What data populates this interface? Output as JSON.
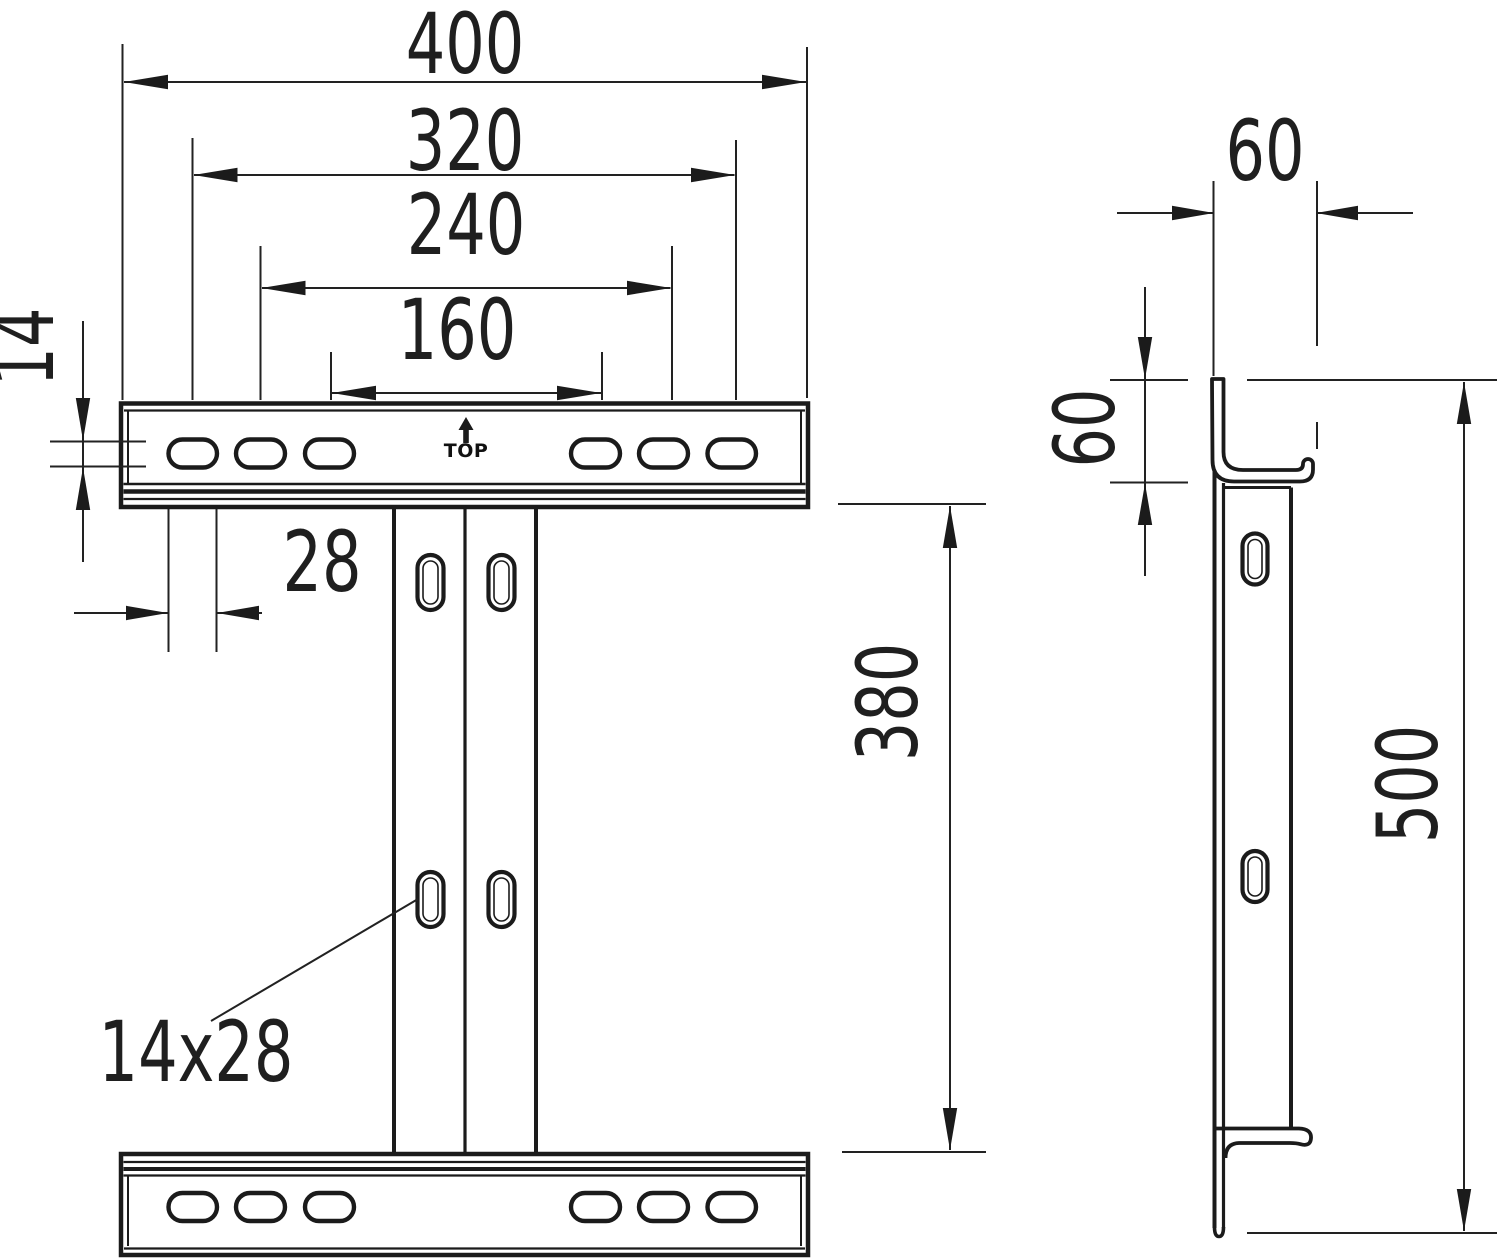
{
  "drawing": {
    "type": "technical-dimension-drawing",
    "views": {
      "front_view": "bracket front view with slotted head and foot rails",
      "side_view": "bracket side profile view"
    },
    "dimensions": {
      "overall_width": "400",
      "hole_pitch_outer": "320",
      "hole_pitch_middle": "240",
      "hole_pitch_inner": "160",
      "slot_height": "14",
      "slot_width": "28",
      "slot_size": "14x28",
      "web_clear_height": "380",
      "flange_depth": "60",
      "flange_rise": "60",
      "overall_height": "500"
    },
    "markings": {
      "orientation_label": "TOP"
    }
  }
}
